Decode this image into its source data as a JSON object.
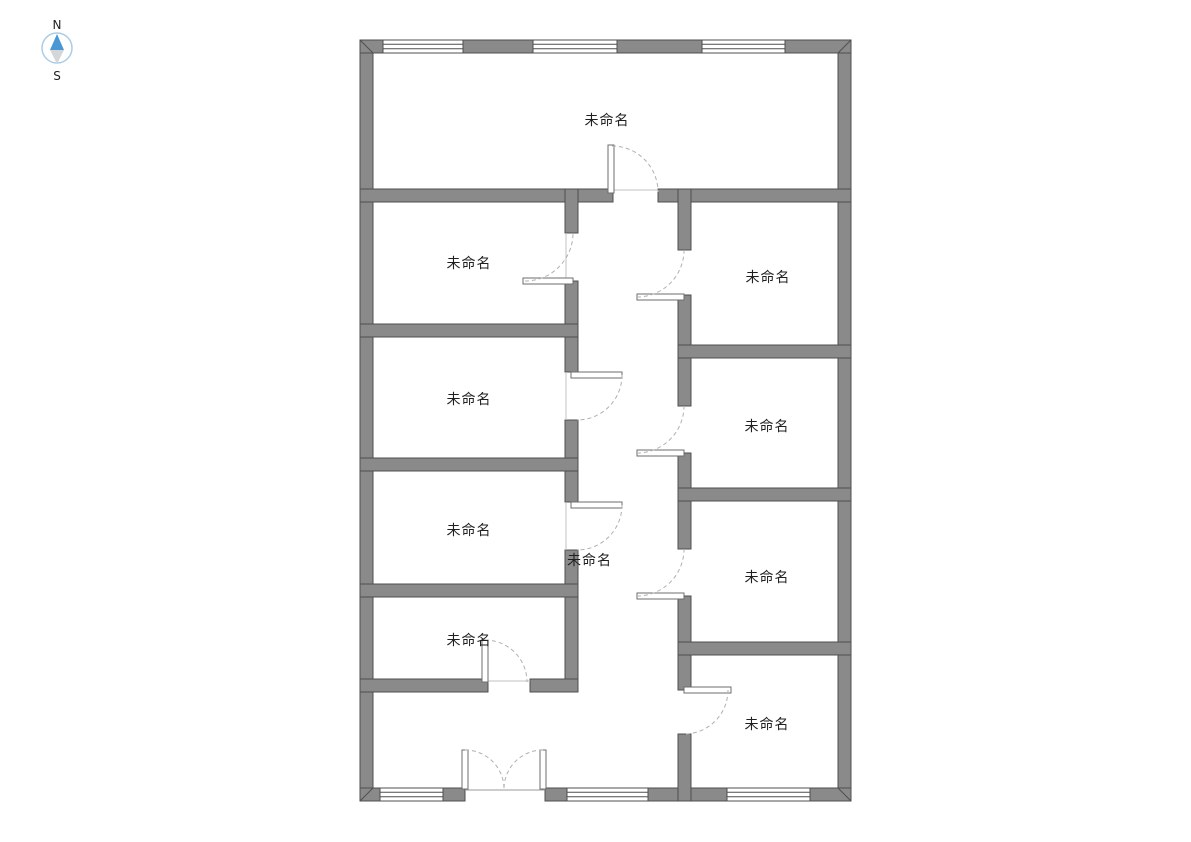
{
  "compass": {
    "north_label": "N",
    "south_label": "S",
    "colors": {
      "ring": "#a9cde9",
      "needle_north": "#4a97d6",
      "needle_south": "#d3d7da"
    }
  },
  "floorplan": {
    "rooms": [
      {
        "id": "room-north",
        "label": "未命名"
      },
      {
        "id": "room-west-1",
        "label": "未命名"
      },
      {
        "id": "room-east-1",
        "label": "未命名"
      },
      {
        "id": "room-west-2",
        "label": "未命名"
      },
      {
        "id": "room-east-2",
        "label": "未命名"
      },
      {
        "id": "room-west-3",
        "label": "未命名"
      },
      {
        "id": "hallway",
        "label": "未命名"
      },
      {
        "id": "room-east-3",
        "label": "未命名"
      },
      {
        "id": "room-west-4",
        "label": "未命名"
      },
      {
        "id": "room-east-4",
        "label": "未命名"
      }
    ],
    "colors": {
      "wall_fill": "#8a8a8a",
      "wall_outline": "#4f4f4f",
      "door_arc": "#b0b0b0",
      "label_text": "#1f1f1f",
      "background": "#ffffff"
    }
  }
}
